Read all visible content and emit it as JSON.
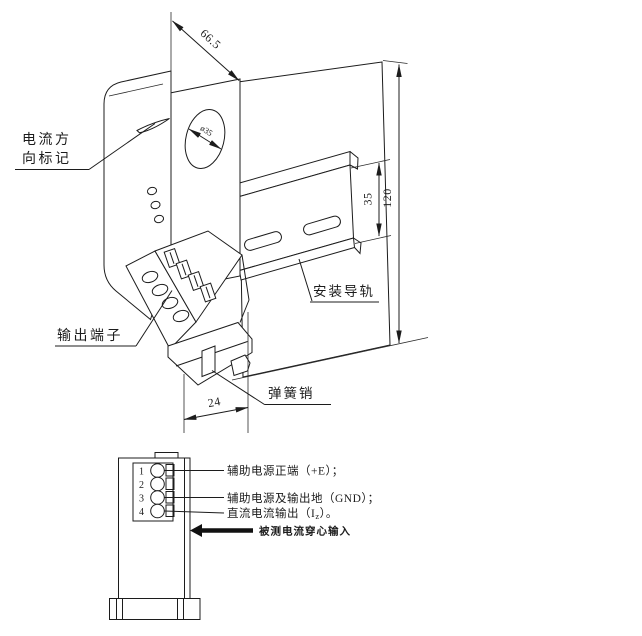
{
  "page": {
    "background": "#ffffff",
    "line_color": "#1c1c1c"
  },
  "isometric": {
    "callouts": {
      "current_direction_line1": "电流方",
      "current_direction_line2": "向标记",
      "output_terminal": "输出端子",
      "mounting_rail": "安装导轨",
      "spring_pin": "弹簧销"
    },
    "dimensions": {
      "top_width": "66.5",
      "hole_diameter": "ø35",
      "rail_height": "35",
      "overall_height": "120",
      "foot_width": "24"
    }
  },
  "front_view": {
    "terminals": [
      "1",
      "2",
      "3",
      "4"
    ],
    "annotations": {
      "aux_power_positive": "辅助电源正端（+E）；",
      "aux_power_ground": "辅助电源及输出地（GND）；",
      "dc_output_pre": "直流电流输出（I",
      "dc_output_sub": "z",
      "dc_output_post": "）。",
      "measured_current_input": "被测电流穿心输入"
    }
  }
}
